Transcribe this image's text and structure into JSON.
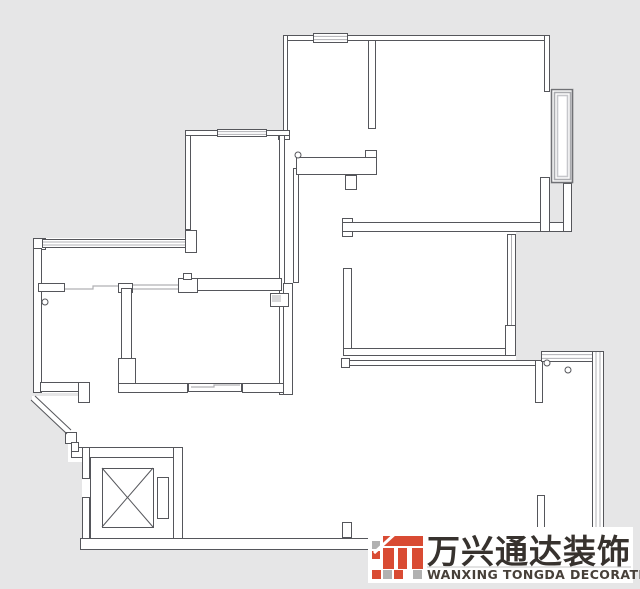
{
  "meta": {
    "bg": "#e6e6e7",
    "floor_fill": "#ffffff",
    "wall_stroke": "#55565b",
    "window_line": "#b0b0b4",
    "bay_frame_dark": "#707175",
    "bay_frame_mid": "#aaabaf",
    "bay_frame_light": "#c6c7cb"
  },
  "plan": {
    "white_areas": [
      [
        283,
        35,
        267,
        197
      ],
      [
        550,
        88,
        23,
        95
      ],
      [
        185,
        130,
        108,
        153
      ],
      [
        33,
        238,
        260,
        155
      ],
      [
        281,
        135,
        71,
        260
      ],
      [
        343,
        222,
        173,
        144
      ],
      [
        343,
        366,
        200,
        26
      ],
      [
        88,
        390,
        455,
        152
      ],
      [
        543,
        356,
        57,
        184
      ],
      [
        82,
        458,
        8,
        82
      ]
    ],
    "entry_polygon": "32,396 90,396 90,462 68,462 68,434 32,401",
    "walls": [
      [
        283,
        35,
        267,
        6
      ],
      [
        283,
        35,
        5,
        100
      ],
      [
        278,
        130,
        12,
        10
      ],
      [
        279,
        132,
        6,
        263
      ],
      [
        293,
        168,
        6,
        115
      ],
      [
        368,
        40,
        8,
        89
      ],
      [
        296,
        157,
        81,
        18
      ],
      [
        365,
        150,
        12,
        8
      ],
      [
        345,
        175,
        12,
        15
      ],
      [
        342,
        218,
        11,
        19
      ],
      [
        342,
        222,
        230,
        10
      ],
      [
        544,
        35,
        6,
        57
      ],
      [
        540,
        177,
        10,
        55
      ],
      [
        563,
        183,
        9,
        49
      ],
      [
        343,
        268,
        9,
        84
      ],
      [
        343,
        348,
        173,
        8
      ],
      [
        343,
        360,
        194,
        6
      ],
      [
        341,
        358,
        9,
        10
      ],
      [
        535,
        360,
        8,
        43
      ],
      [
        537,
        495,
        8,
        43
      ],
      [
        342,
        522,
        10,
        16
      ],
      [
        505,
        325,
        11,
        31
      ],
      [
        185,
        130,
        6,
        100
      ],
      [
        185,
        230,
        12,
        23
      ],
      [
        185,
        130,
        105,
        6
      ],
      [
        33,
        238,
        13,
        12
      ],
      [
        33,
        248,
        9,
        145
      ],
      [
        38,
        283,
        27,
        9
      ],
      [
        118,
        283,
        15,
        10
      ],
      [
        121,
        288,
        11,
        105
      ],
      [
        118,
        358,
        18,
        35
      ],
      [
        178,
        278,
        20,
        15
      ],
      [
        183,
        273,
        9,
        7
      ],
      [
        197,
        278,
        85,
        13
      ],
      [
        40,
        382,
        40,
        10
      ],
      [
        78,
        382,
        12,
        21
      ],
      [
        118,
        383,
        70,
        10
      ],
      [
        242,
        383,
        51,
        10
      ],
      [
        283,
        283,
        10,
        112
      ],
      [
        71,
        447,
        112,
        11
      ],
      [
        173,
        447,
        10,
        93
      ],
      [
        82,
        447,
        8,
        32
      ],
      [
        82,
        497,
        8,
        43
      ],
      [
        65,
        432,
        12,
        12
      ],
      [
        71,
        442,
        8,
        10
      ],
      [
        80,
        538,
        518,
        12
      ]
    ],
    "windows": [
      {
        "r": [
          313,
          33,
          35,
          10
        ],
        "o": "h",
        "n": 2
      },
      {
        "r": [
          217,
          129,
          50,
          8
        ],
        "o": "h",
        "n": 2
      },
      {
        "r": [
          42,
          239,
          144,
          9
        ],
        "o": "h",
        "n": 2
      },
      {
        "r": [
          188,
          383,
          54,
          9
        ],
        "o": "h",
        "n": 0
      },
      {
        "r": [
          507,
          234,
          9,
          92
        ],
        "o": "v",
        "n": 1
      },
      {
        "r": [
          541,
          351,
          63,
          11
        ],
        "o": "h",
        "n": 2
      },
      {
        "r": [
          592,
          351,
          12,
          189
        ],
        "o": "v",
        "n": 2
      }
    ],
    "thin_polylines": [
      "65,289 93,289 93,286 118,286",
      "133,285 178,285",
      "133,289 178,289",
      "191,387 214,387 214,385 240,385"
    ],
    "diagonal_lines": [
      [
        31,
        400,
        67,
        434
      ],
      [
        35,
        396,
        71,
        430
      ]
    ],
    "circles": [
      [
        298,
        155,
        3
      ],
      [
        45,
        302,
        3
      ],
      [
        547,
        363,
        3
      ],
      [
        568,
        370,
        3
      ]
    ],
    "elevator": {
      "shaft": [
        90,
        457,
        83,
        81
      ],
      "car": [
        102,
        468,
        51,
        59
      ],
      "panel": [
        157,
        477,
        11,
        41
      ]
    },
    "bay_window": {
      "base": [
        550,
        88,
        23,
        95
      ],
      "frames": [
        [
          551,
          89,
          21,
          93
        ],
        [
          554,
          92,
          16,
          87
        ],
        [
          557,
          95,
          10,
          81
        ]
      ]
    },
    "door_box": {
      "rect": [
        270,
        293,
        18,
        13
      ],
      "inner": [
        272,
        295,
        9,
        7
      ]
    }
  },
  "logo": {
    "box": [
      368,
      527,
      265,
      56
    ],
    "cn_text": "万兴通达装饰",
    "en_text": "WANXING TONGDA DECORATION",
    "cn_color": "#37322e",
    "en_color": "#474039",
    "red": "#d94b33",
    "gray": "#b1b1b1",
    "rule_color": "#c5c5c5",
    "squares": [
      {
        "r": [
          372,
          541,
          8,
          8
        ],
        "c": "gray"
      },
      {
        "r": [
          383,
          536,
          40,
          10
        ],
        "c": "red"
      },
      {
        "r": [
          383,
          548,
          11,
          21
        ],
        "c": "red"
      },
      {
        "r": [
          398,
          548,
          9,
          21
        ],
        "c": "red"
      },
      {
        "r": [
          412,
          548,
          11,
          21
        ],
        "c": "red"
      },
      {
        "r": [
          372,
          551,
          8,
          8
        ],
        "c": "red"
      },
      {
        "r": [
          372,
          570,
          9,
          9
        ],
        "c": "red"
      },
      {
        "r": [
          383,
          570,
          9,
          9
        ],
        "c": "gray"
      },
      {
        "r": [
          394,
          570,
          9,
          9
        ],
        "c": "red"
      },
      {
        "r": [
          413,
          570,
          9,
          9
        ],
        "c": "gray"
      }
    ],
    "slash": [
      374,
      553,
      397,
      532
    ]
  }
}
